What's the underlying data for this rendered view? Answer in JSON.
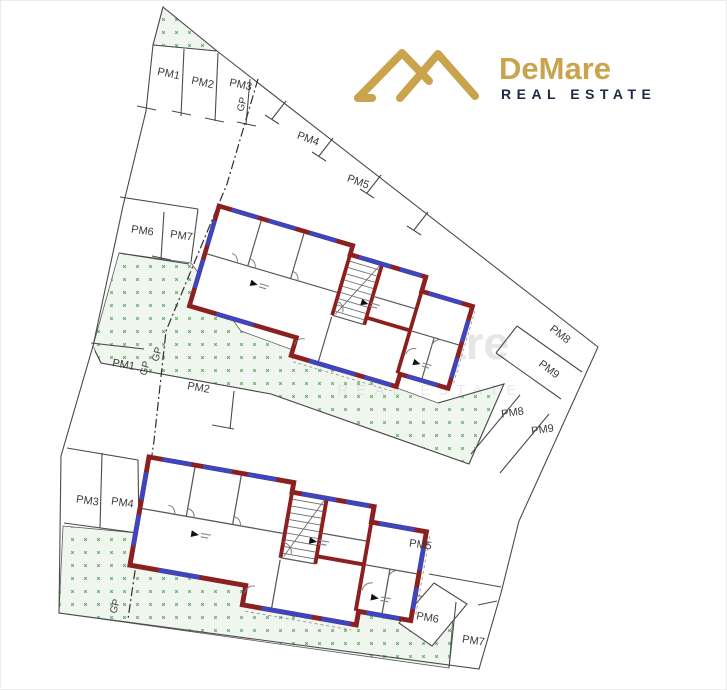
{
  "logo": {
    "brand": "DeMare",
    "tagline": "REAL ESTATE"
  },
  "watermark": {
    "brand": "DeMare",
    "tagline": "REAL ESTATE"
  },
  "parking_upper": [
    "PM1",
    "PM2",
    "PM3",
    "PM4",
    "PM5",
    "PM6",
    "PM7",
    "PM8",
    "PM9"
  ],
  "parking_lower": [
    "PM1",
    "PM2",
    "PM3",
    "PM4",
    "PM5",
    "PM6",
    "PM7",
    "PM8",
    "PM9"
  ],
  "boundary_labels": [
    "GP",
    "GP",
    "GP",
    "GP"
  ],
  "colors": {
    "brand_gold": "#C9A44C",
    "brand_navy": "#1C2B45",
    "wall_red": "#8C1F1F",
    "window_blue": "#3947C4",
    "boundary_gray": "#4A4A4A",
    "landscape_green": "#55A25F",
    "landscape_fill": "#EEF6EE",
    "watermark_gray": "#C9C9C9"
  }
}
